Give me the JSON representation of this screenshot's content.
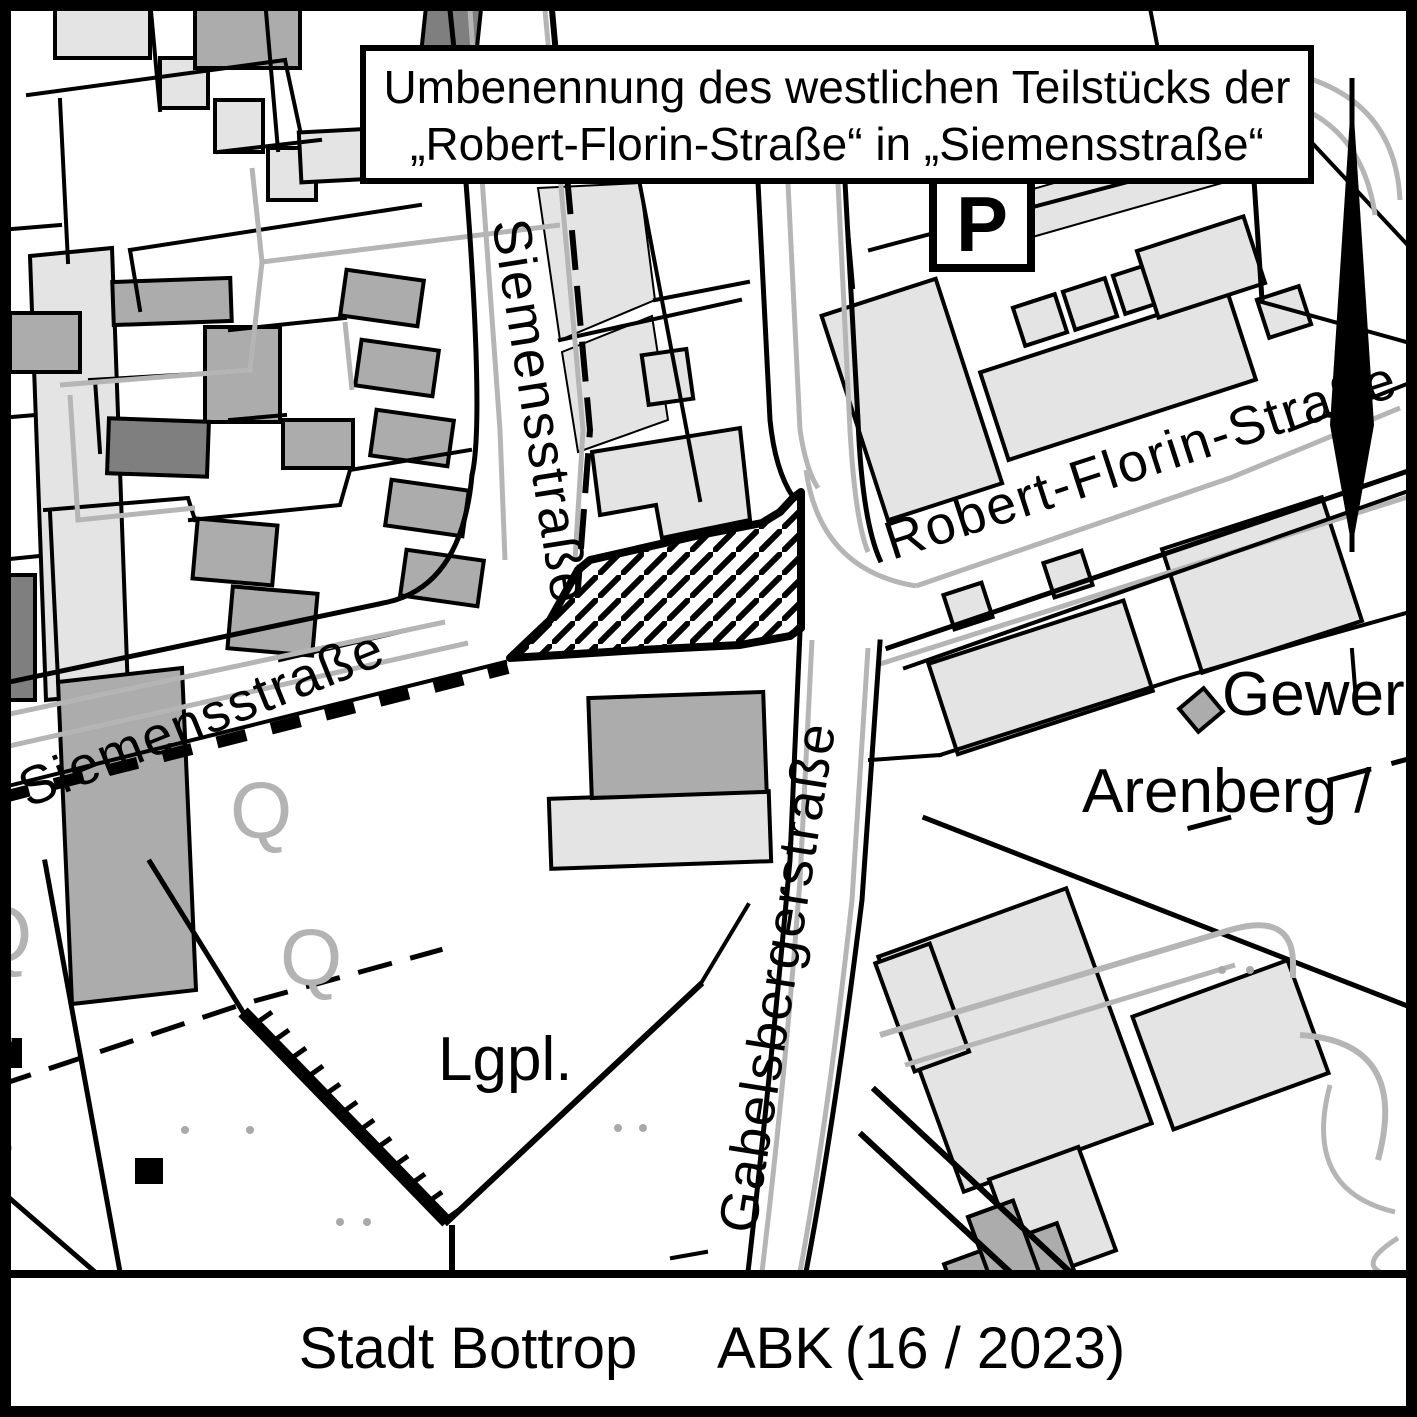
{
  "map": {
    "title_box": {
      "line1": "Umbenennung des westlichen Teilstücks der",
      "line2": "„Robert-Florin-Straße“ in „Siemensstraße“"
    },
    "street_labels": {
      "siemensstrasse_upper": "Siemensstraße",
      "siemensstrasse_lower": "Siemensstraße",
      "robert_florin_strasse": "Robert-Florin-Straße",
      "gabelsbergerstrasse": "Gabelsbergerstraße"
    },
    "area_labels": {
      "gewerbegebiet_partial": "Gewer",
      "arenberg": "Arenberg /",
      "lagerplatz_abbrev": "Lgpl."
    },
    "symbols": {
      "parking": "P",
      "q_upper": "Q",
      "q_lower": "Q",
      "q_edge": "Q"
    },
    "colors": {
      "line_black": "#000000",
      "building_mid": "#acacac",
      "building_light": "#e4e4e4",
      "building_dark": "#7f7f7f",
      "curb_gray": "#b5b5b5",
      "label_gray": "#b3b3b3"
    }
  },
  "footer": {
    "city": "Stadt Bottrop",
    "code": "ABK",
    "issue": "(16 / 2023)"
  }
}
